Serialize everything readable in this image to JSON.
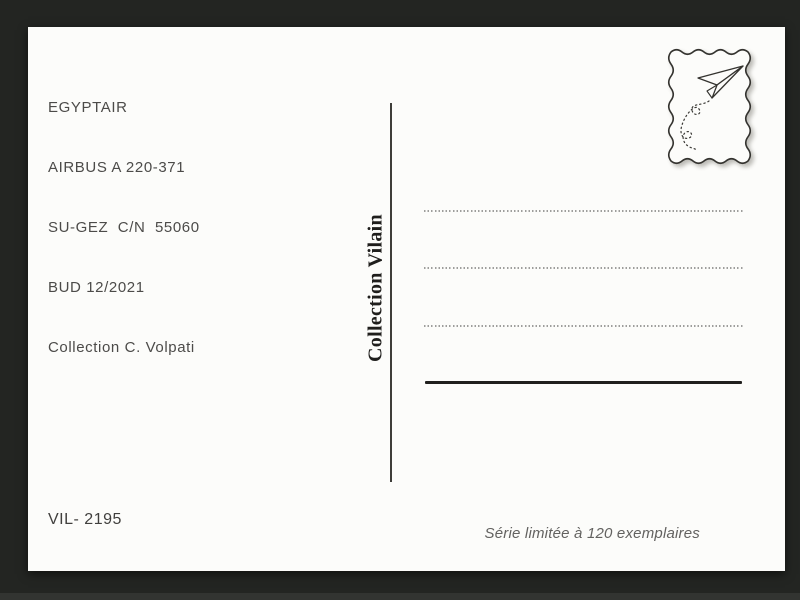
{
  "card": {
    "caption": {
      "lines": [
        "EGYPTAIR",
        "AIRBUS A 220-371",
        "SU-GEZ  C/N  55060",
        "BUD 12/2021",
        "Collection C. Volpati"
      ]
    },
    "publisher": "Collection Vilain",
    "catalog_number": "VIL- 2195",
    "edition_note": "Série limitée à 120 exemplaires",
    "stamp": {
      "icon": "paper-plane-icon",
      "style": "hand-drawn wavy stamp frame with dotted flight trail"
    }
  },
  "colors": {
    "background": "#232522",
    "card": "#fcfcfa",
    "caption_ink": "#4c4b49",
    "title_ink": "#1f1e1c",
    "muted_ink": "#636260",
    "rule": "#201f1d",
    "dotted": "#8e8e8c"
  }
}
